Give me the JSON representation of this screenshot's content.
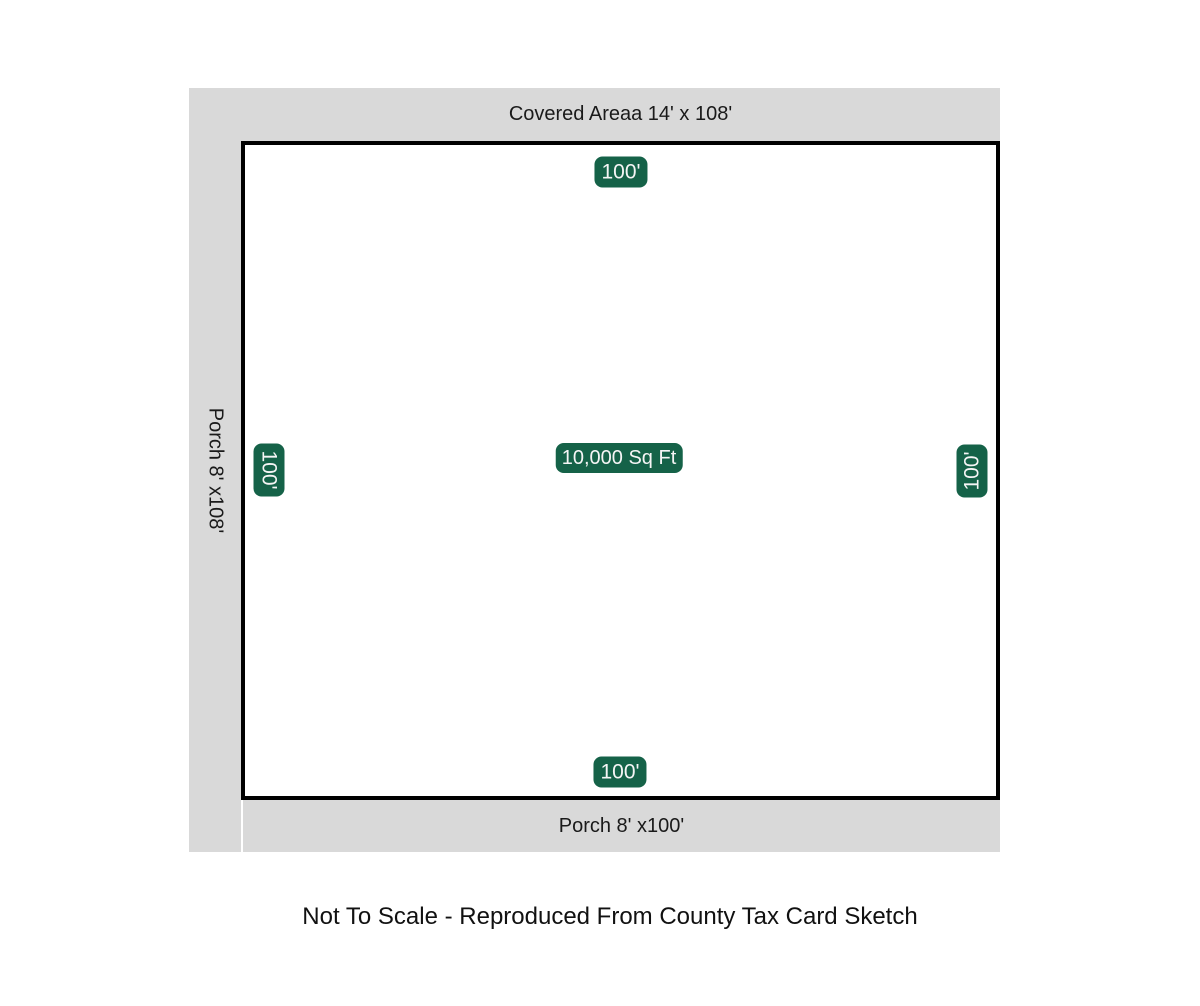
{
  "diagram": {
    "covered_area": {
      "label": "Covered Areaa 14' x 108'"
    },
    "porch_left": {
      "label": "Porch 8' x108'"
    },
    "porch_bottom": {
      "label": "Porch 8' x100'"
    },
    "lot": {
      "area": "10,000 Sq Ft",
      "side_top": "100'",
      "side_left": "100'",
      "side_right": "100'",
      "side_bottom": "100'"
    },
    "colors": {
      "strip_bg": "#d9d9d9",
      "lot_border": "#000000",
      "lot_fill": "#ffffff",
      "badge_bg": "#156248",
      "badge_text": "#f5f5f5",
      "label_text": "#1a1a1a"
    }
  },
  "footer": {
    "note": "Not To Scale - Reproduced From County Tax Card Sketch"
  }
}
